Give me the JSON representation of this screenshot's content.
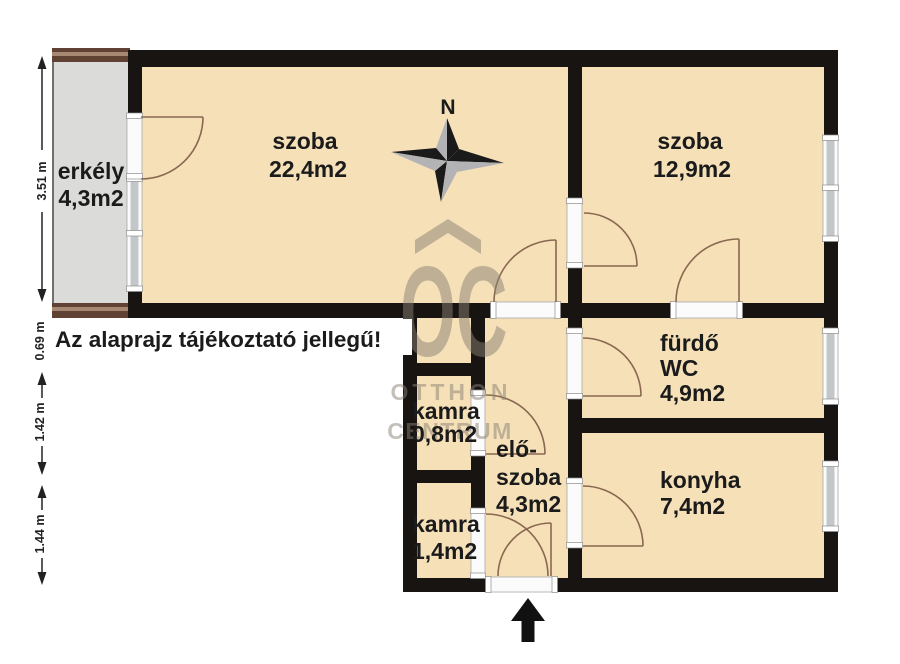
{
  "palette": {
    "wall": "#181412",
    "room_fill": "#f5e0b8",
    "balcony_fill": "#dbdbd9",
    "balcony_trim": "#5f4234",
    "balcony_trim_light": "#a78872",
    "window_glass": "#c3c7ca",
    "arc": "#8a6850",
    "watermark": "#8a8174",
    "ink": "#1b1b1b"
  },
  "rooms": {
    "szoba_large": {
      "name": "szoba",
      "area": "22,4m2"
    },
    "szoba_small": {
      "name": "szoba",
      "area": "12,9m2"
    },
    "erkely": {
      "name": "erkély",
      "area": "4,3m2"
    },
    "furdo": {
      "name": "fürdő",
      "name2": "WC",
      "area": "4,9m2"
    },
    "konyha": {
      "name": "konyha",
      "area": "7,4m2"
    },
    "kamra_small": {
      "name": "kamra",
      "area": "0,8m2"
    },
    "eloszoba": {
      "name": "elő-",
      "name2": "szoba",
      "area": "4,3m2"
    },
    "kamra_large": {
      "name": "kamra",
      "area": "1,4m2"
    }
  },
  "dimensions": {
    "balcony_height": "3.51 m",
    "offset": "0.69 m",
    "mid": "1.42 m",
    "lower": "1.44 m"
  },
  "compass": {
    "north": "N"
  },
  "note": "Az alaprajz tájékoztató jellegű!",
  "watermark": {
    "monogram": "OC",
    "brand_line1": "OTTHON",
    "brand_line2": "CENTRUM"
  }
}
